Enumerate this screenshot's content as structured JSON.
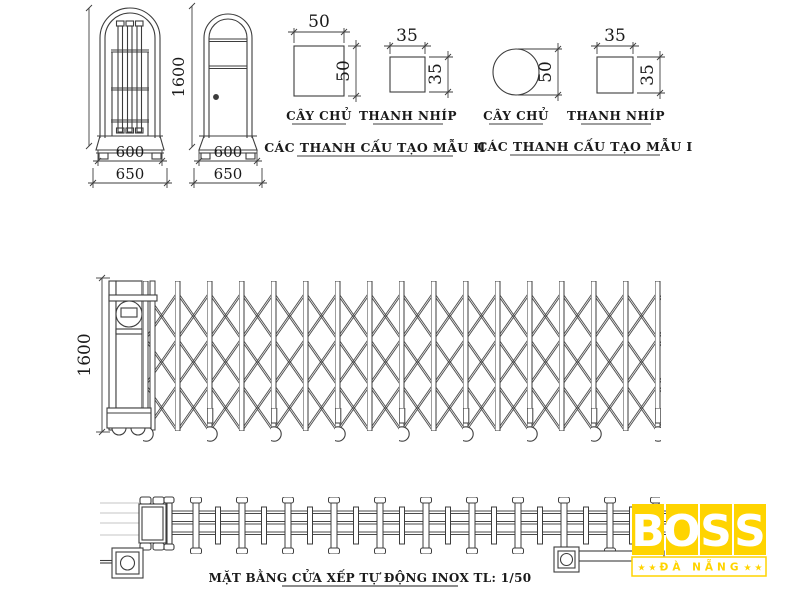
{
  "drawing": {
    "posts_front_views": {
      "height": "1600",
      "post_a": {
        "inner_width": "600",
        "outer_width": "650"
      },
      "post_b": {
        "inner_width": "600",
        "outer_width": "650"
      }
    },
    "model2": {
      "title": "CÁC THANH CẤU TẠO MẪU II",
      "cay_chu": {
        "label": "CÂY CHỦ",
        "dim_top": "50",
        "dim_side": "50"
      },
      "thanh_nhip": {
        "label": "THANH NHÍP",
        "dim_top": "35",
        "dim_side": "35"
      }
    },
    "model1": {
      "title": "CÁC THANH CẤU TẠO MẪU I",
      "cay_chu": {
        "label": "CÂY CHỦ",
        "dim_side": "50"
      },
      "thanh_nhip": {
        "label": "THANH NHÍP",
        "dim_top": "35",
        "dim_side": "35"
      }
    },
    "gate_elevation": {
      "height": "1600"
    },
    "plan_caption": "MẶT BẰNG CỬA XẾP TỰ ĐỘNG INOX  TL: 1/50"
  },
  "logo": {
    "letters": [
      "B",
      "O",
      "S",
      "S"
    ],
    "subtitle": "ĐÀ NẴNG",
    "stars_left": "★ ★",
    "stars_right": "★ ★",
    "yellow": "#ffd400"
  },
  "colors": {
    "line": "#3d3d3d",
    "guide": "#c6c6c6"
  }
}
